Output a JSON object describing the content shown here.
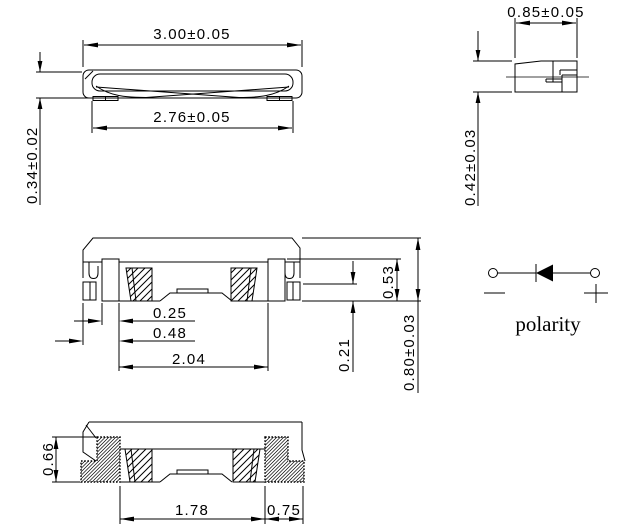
{
  "drawing": {
    "colors": {
      "line": "#000000",
      "background": "#ffffff"
    },
    "views": {
      "top": {
        "dim_width": "3.00±0.05",
        "dim_inner_width": "2.76±0.05",
        "dim_thickness": "0.34±0.02"
      },
      "side": {
        "dim_width": "0.85±0.05",
        "dim_height": "0.42±0.03"
      },
      "section": {
        "dim_lead_width": "0.25",
        "dim_edge_to_lead": "0.48",
        "dim_lead_span": "2.04",
        "dim_cavity_height": "0.53",
        "dim_standoff": "0.21",
        "dim_total_height": "0.80±0.03"
      },
      "bottom": {
        "dim_terminal_height": "0.66",
        "dim_pad_span": "1.78",
        "dim_pad_width": "0.75"
      },
      "polarity": {
        "label": "polarity"
      }
    }
  }
}
